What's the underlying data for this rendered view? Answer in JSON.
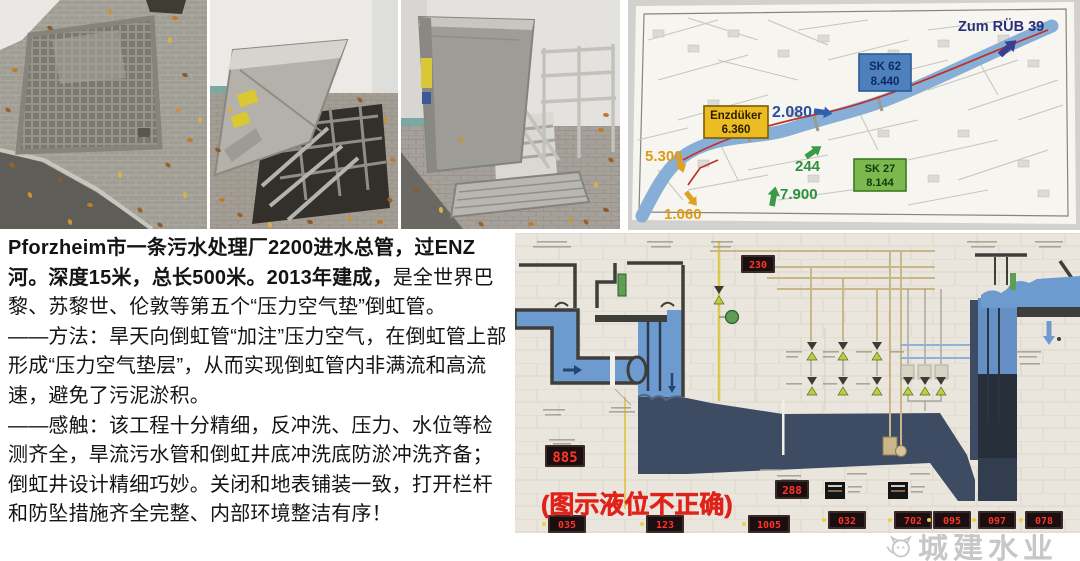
{
  "article": {
    "paragraphs": [
      {
        "segments": [
          {
            "text": "Pforzheim市一条污水处理厂2200进水总管，过ENZ河。深度15米，总长500米。2013年建成，",
            "bold": true
          },
          {
            "text": "是全世界巴黎、苏黎世、伦敦等第五个“压力空气垫”倒虹管。",
            "bold": false
          }
        ]
      },
      {
        "segments": [
          {
            "text": "——方法：旱天向倒虹管“加注”压力空气，在倒虹管上部形成“压力空气垫层”，从而实现倒虹管内非满流和高流速，避免了污泥淤积。",
            "bold": false
          }
        ]
      },
      {
        "segments": [
          {
            "text": "——感触：该工程十分精细，反冲洗、压力、水位等检测齐全，旱流污水管和倒虹井底冲洗底防淤冲洗齐备；倒虹井设计精细巧妙。关闭和地表铺装一致，打开栏杆和防坠措施齐全完整、内部环境整洁有序！",
            "bold": false
          }
        ]
      }
    ]
  },
  "map": {
    "direction_label": "Zum RÜB 39",
    "flow_2080": "2.080",
    "flow_244": "244",
    "flow_7900": "7.900",
    "flow_5300": "5.300",
    "flow_1060": "1.060",
    "boxes": {
      "enzduker": {
        "title": "Enzdüker",
        "value": "6.360"
      },
      "sk62": {
        "title": "SK 62",
        "value": "8.440"
      },
      "sk27": {
        "title": "SK 27",
        "value": "8.144"
      }
    },
    "colors": {
      "river": "#86aed6",
      "route": "#c03028",
      "navy": "#2a2f7a",
      "blue": "#2a4f9e",
      "green": "#2e8f3e",
      "orange": "#dd9b17"
    }
  },
  "schematic": {
    "overlay_note": "(图示液位不正确)",
    "note_color": "#e1221b",
    "displays": [
      {
        "id": "top-display",
        "value": "230"
      },
      {
        "id": "mid-left-display",
        "value": "885"
      },
      {
        "id": "mid-right-display",
        "value": "288"
      },
      {
        "id": "bottom-display-1",
        "value": "035"
      },
      {
        "id": "bottom-display-2",
        "value": "123"
      },
      {
        "id": "bottom-display-3",
        "value": "1005"
      },
      {
        "id": "bottom-display-4",
        "value": "032"
      },
      {
        "id": "bottom-display-5",
        "value": "702"
      },
      {
        "id": "bottom-display-6",
        "value": "095"
      },
      {
        "id": "bottom-display-7",
        "value": "097"
      },
      {
        "id": "bottom-display-8",
        "value": "078"
      }
    ]
  },
  "watermark": {
    "text": "城建水业"
  }
}
